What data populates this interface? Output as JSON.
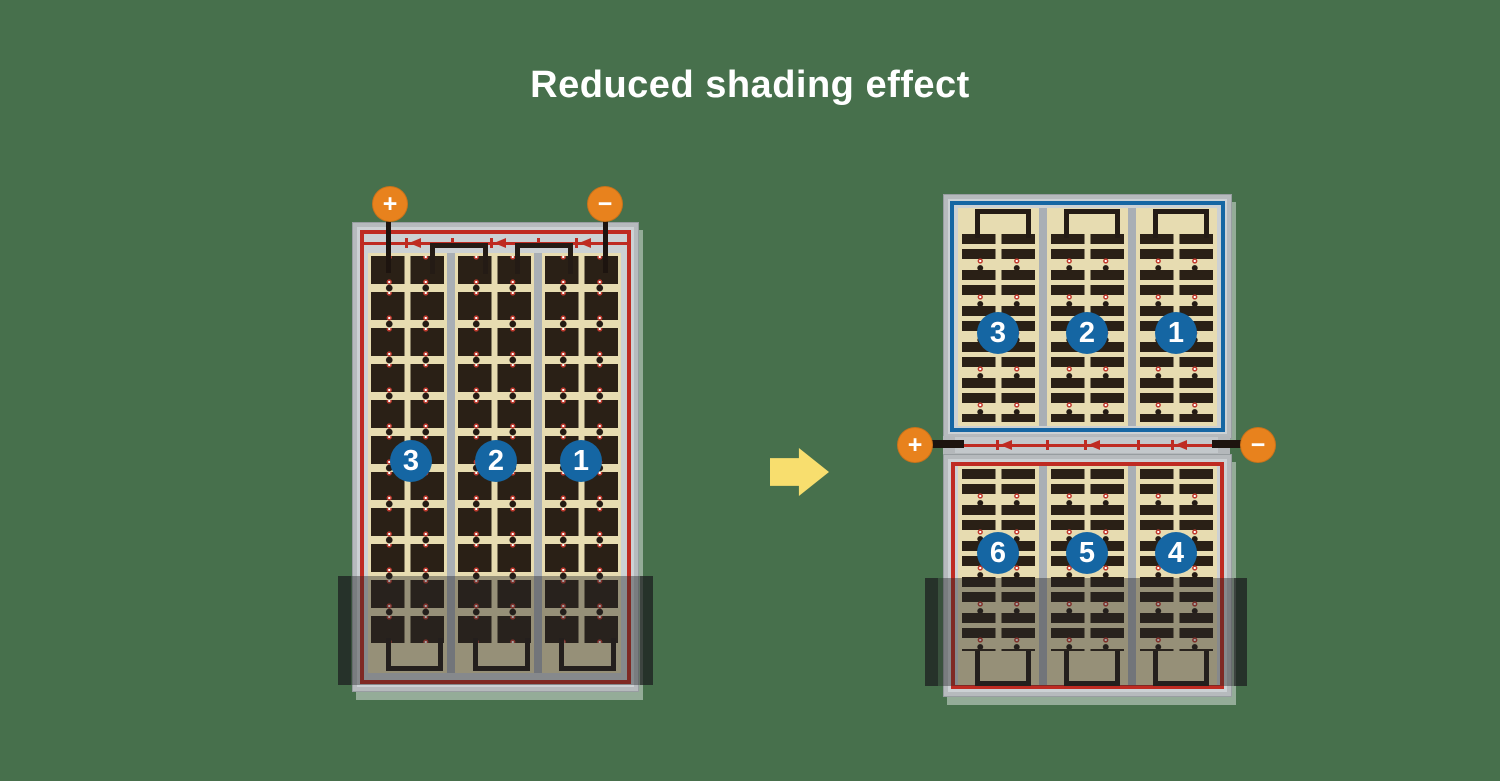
{
  "title": "Reduced shading effect",
  "terminals": {
    "plus": "+",
    "minus": "−"
  },
  "left_panel": {
    "strings": [
      "3",
      "2",
      "1"
    ]
  },
  "right_panel": {
    "top_strings": [
      "3",
      "2",
      "1"
    ],
    "bottom_strings": [
      "6",
      "5",
      "4"
    ]
  },
  "colors": {
    "bg": "#47704c",
    "orange": "#e8821d",
    "blue": "#1566a3",
    "red": "#bf2b22",
    "tan": "#e7dcb1",
    "cell": "#2a2016",
    "frame": "#b6babd",
    "yellow": "#f8de6e",
    "wire": "#1d140f"
  }
}
